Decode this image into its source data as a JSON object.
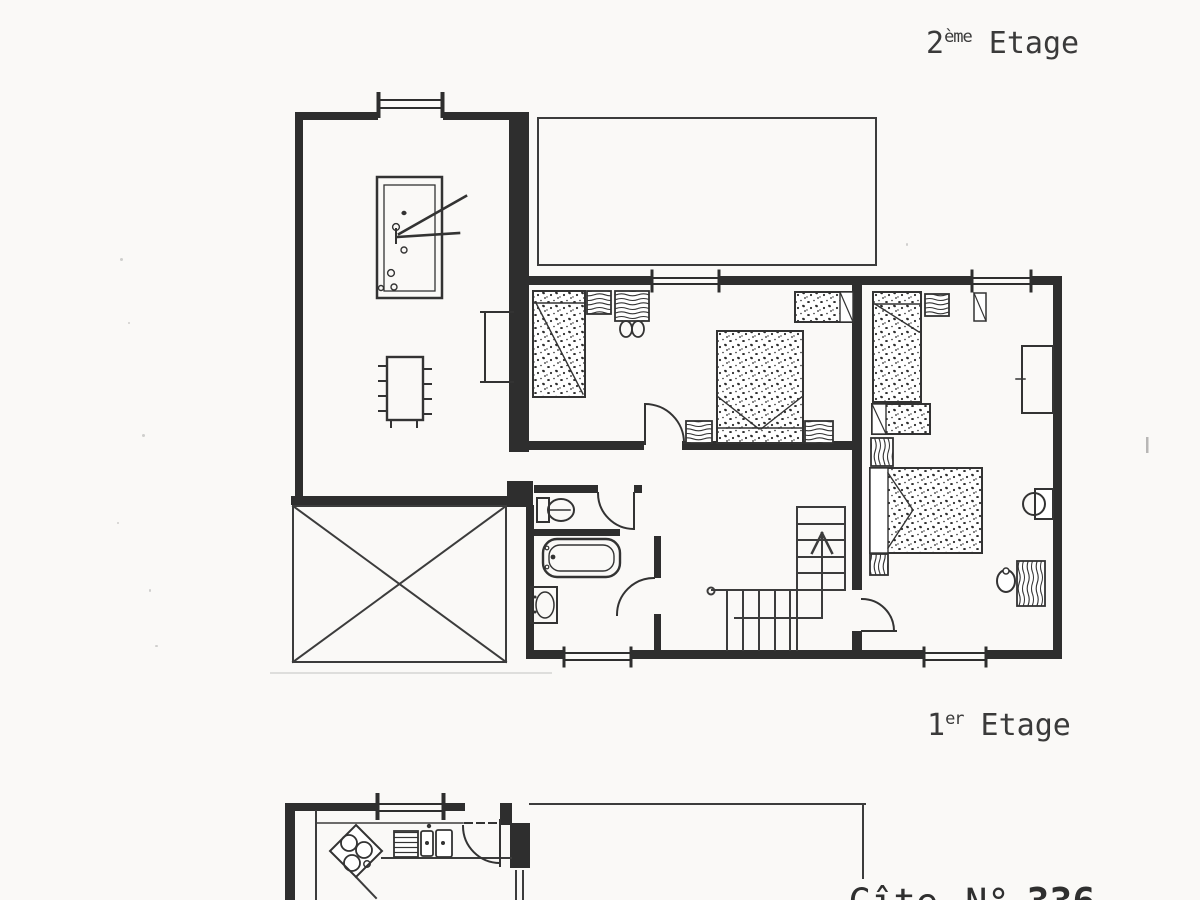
{
  "labels": {
    "floor2": {
      "number": "2",
      "suffix": "ème",
      "word": "Etage"
    },
    "floor1": {
      "number": "1",
      "suffix": "er",
      "word": "Etage"
    },
    "gite": {
      "word": "Gîte",
      "number_sign": "N°",
      "number": "336"
    }
  },
  "colors": {
    "background": "#faf9f7",
    "ink": "#2e2e2e",
    "line": "#3c3c3c",
    "faint_mark": "#999999"
  },
  "floor2_items": [
    "billiard-table",
    "dining-table",
    "wall-closet",
    "crossed-terrace",
    "single-bed",
    "nightstand",
    "desk",
    "chair",
    "double-bed",
    "small-bed",
    "wardrobe",
    "toilet",
    "bathtub",
    "washbasin",
    "staircase-up-arrow",
    "windows",
    "doors"
  ],
  "floor1_items": [
    "kitchen-stove",
    "kitchen-sink",
    "draining-board",
    "counter",
    "entry-door-dashed"
  ]
}
